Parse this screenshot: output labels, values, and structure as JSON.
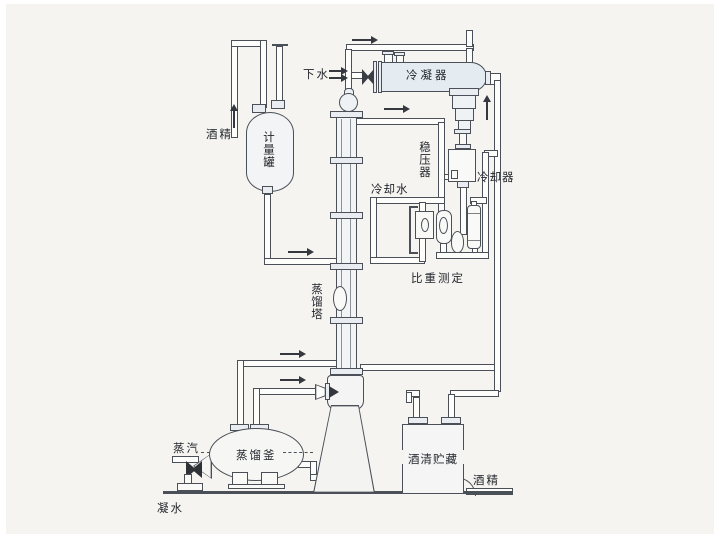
{
  "diagram": {
    "labels": {
      "drain_water": "下水",
      "condenser": "冷凝器",
      "pressure_stabilizer": "稳压器",
      "cooling_water": "冷却水",
      "cooler": "冷却器",
      "gravity_measurement": "比重测定",
      "distillation_column": "蒸馏塔",
      "measuring_tank": "计量罐",
      "alcohol_feed": "酒精",
      "steam": "蒸汽",
      "distillation_kettle": "蒸馏釜",
      "condensate": "凝水",
      "alcohol_storage": "酒清贮藏",
      "alcohol_out": "酒精"
    },
    "colors": {
      "line": "#4b4f57",
      "paper": "#f5f4f0",
      "vessel_fill": "#eef2f5",
      "text": "#23262c"
    }
  }
}
